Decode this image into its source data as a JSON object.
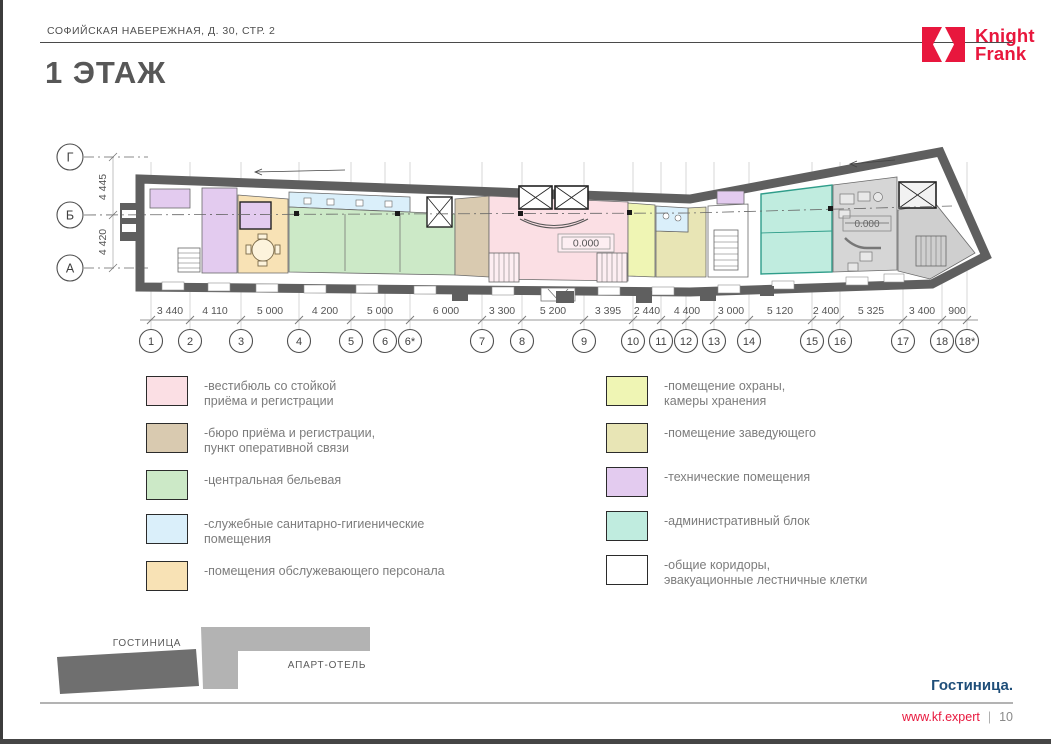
{
  "page": {
    "breadcrumb": "СОФИЙСКАЯ НАБЕРЕЖНАЯ, Д. 30, СТР. 2",
    "title": "1 ЭТАЖ",
    "footer_project": "Гостиница.",
    "footer_site": "www.kf.expert",
    "footer_divider": "|",
    "footer_page": "10"
  },
  "logo": {
    "line1": "Knight",
    "line2": "Frank",
    "color": "#e8173d"
  },
  "plan": {
    "row_axes": [
      "Г",
      "Б",
      "А"
    ],
    "row_dims": [
      "4 445",
      "4 420"
    ],
    "columns": [
      "1",
      "2",
      "3",
      "4",
      "5",
      "6",
      "6*",
      "7",
      "8",
      "9",
      "10",
      "11",
      "12",
      "13",
      "14",
      "15",
      "16",
      "17",
      "18",
      "18*"
    ],
    "dims": [
      "3 440",
      "4 110",
      "5 000",
      "4 200",
      "5 000",
      "6 000",
      "3 300",
      "5 200",
      "3 395",
      "2 440",
      "4 400",
      "3 000",
      "5 120",
      "2 400",
      "5 325",
      "3 400",
      "900"
    ],
    "level_mark_lobby": "0.000",
    "level_mark_right": "0.000"
  },
  "legend": {
    "left": [
      {
        "color": "#fbdfe4",
        "lines": [
          "-вестибюль со стойкой",
          "приёма и регистрации"
        ]
      },
      {
        "color": "#d9cab0",
        "lines": [
          "-бюро приёма и регистрации,",
          "пункт оперативной связи"
        ]
      },
      {
        "color": "#cce9c7",
        "lines": [
          "-центральная бельевая"
        ]
      },
      {
        "color": "#daeffa",
        "lines": [
          "-служебные санитарно-гигиенические",
          "помещения"
        ]
      },
      {
        "color": "#f8e2b5",
        "lines": [
          "-помещения обслужевающего персонала"
        ]
      }
    ],
    "right": [
      {
        "color": "#eff5b4",
        "lines": [
          "-помещение охраны,",
          "камеры хранения"
        ]
      },
      {
        "color": "#e8e5b5",
        "lines": [
          "-помещение заведующего"
        ]
      },
      {
        "color": "#e3cbef",
        "lines": [
          "-технические помещения"
        ]
      },
      {
        "color": "#c0ecdf",
        "lines": [
          "-административный блок"
        ]
      },
      {
        "color": "#ffffff",
        "lines": [
          "-общие коридоры,",
          "эвакуационные лестничные клетки"
        ]
      }
    ]
  },
  "keyplan": {
    "hotel": "ГОСТИНИЦА",
    "apart": "АПАРТ-ОТЕЛЬ"
  }
}
